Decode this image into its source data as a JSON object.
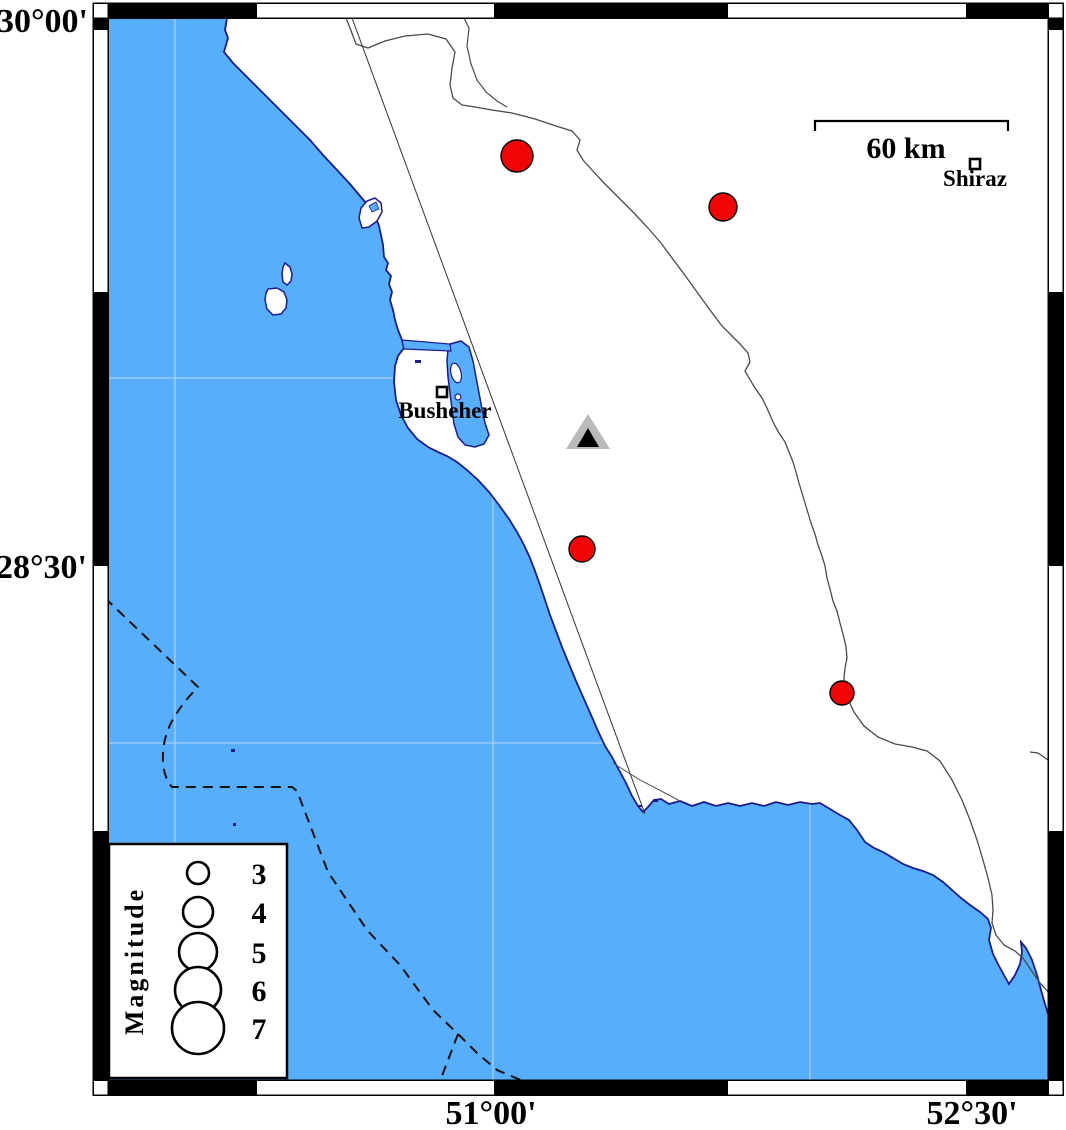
{
  "map": {
    "axis": {
      "top_left_lat": "30°00'",
      "mid_left_lat": "28°30'",
      "bottom_lon_1": "51°00'",
      "bottom_lon_2": "52°30'"
    },
    "scale_bar": {
      "label": "60 km",
      "x1": 815,
      "x2": 1008,
      "y": 121,
      "tick": 10,
      "label_x": 906,
      "label_y": 158
    },
    "cities": [
      {
        "name": "Busheher",
        "marker_x": 442,
        "marker_y": 392,
        "label_x": 445,
        "label_y": 418
      },
      {
        "name": "Shiraz",
        "marker_x": 975,
        "marker_y": 164,
        "label_x": 975,
        "label_y": 186
      }
    ],
    "power_plant": {
      "x": 588,
      "y": 437
    },
    "epicenters": [
      {
        "x": 517,
        "y": 156,
        "r": 16
      },
      {
        "x": 723,
        "y": 207,
        "r": 14
      },
      {
        "x": 582,
        "y": 549,
        "r": 13
      },
      {
        "x": 842,
        "y": 693,
        "r": 12
      }
    ],
    "grid": {
      "verticals_x": [
        175,
        493,
        810
      ],
      "horizontals_y": [
        378,
        743
      ]
    }
  },
  "legend": {
    "title": "Magnitude",
    "circle_x": 198,
    "label_x": 259,
    "entries": [
      {
        "mag": "3",
        "y": 873,
        "r": 11
      },
      {
        "mag": "4",
        "y": 912,
        "r": 15
      },
      {
        "mag": "5",
        "y": 952,
        "r": 19
      },
      {
        "mag": "6",
        "y": 990,
        "r": 23
      },
      {
        "mag": "7",
        "y": 1028,
        "r": 26
      }
    ]
  },
  "colors": {
    "sea": "#57AEFA",
    "land": "#ffffff",
    "coast": "#1b1b8f",
    "epicenter": "#f00505",
    "boundary": "#4a4a4a",
    "grid": "#a5d1f9",
    "plant_gray": "#b9b9b9",
    "frame_black": "#000000"
  }
}
